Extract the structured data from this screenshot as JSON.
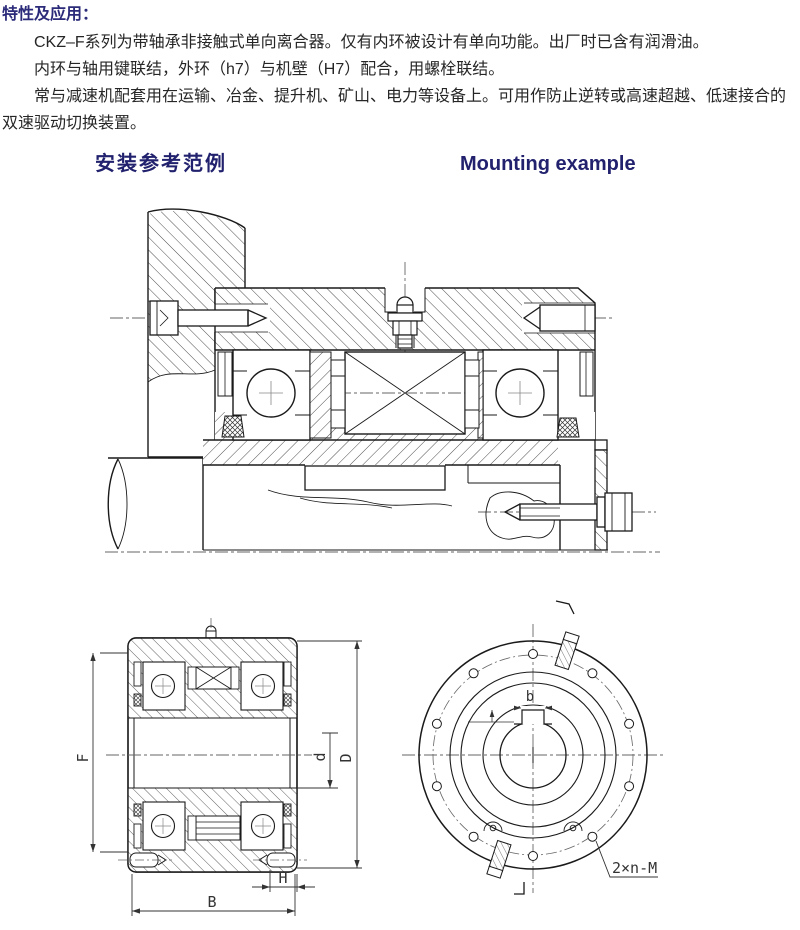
{
  "colors": {
    "navy": "#2b2b7a",
    "body_text": "#262626",
    "line": "#1a1a1a",
    "dim_line": "#333333"
  },
  "intro": {
    "title": "特性及应用：",
    "paragraphs": [
      "CKZ–F系列为带轴承非接触式单向离合器。仅有内环被设计有单向功能。出厂时已含有润滑油。",
      "内环与轴用键联结，外环（h7）与机壁（H7）配合，用螺栓联结。",
      "常与减速机配套用在运输、冶金、提升机、矿山、电力等设备上。可用作防止逆转或高速超越、低速接合的双速驱动切换装置。"
    ]
  },
  "headings": {
    "zh": "安装参考范例",
    "en": "Mounting example"
  },
  "dims": {
    "F": "F",
    "d": "d",
    "D": "D",
    "H": "H",
    "B": "B",
    "keyway_width": "b",
    "bolt_note": "2×n-M"
  }
}
